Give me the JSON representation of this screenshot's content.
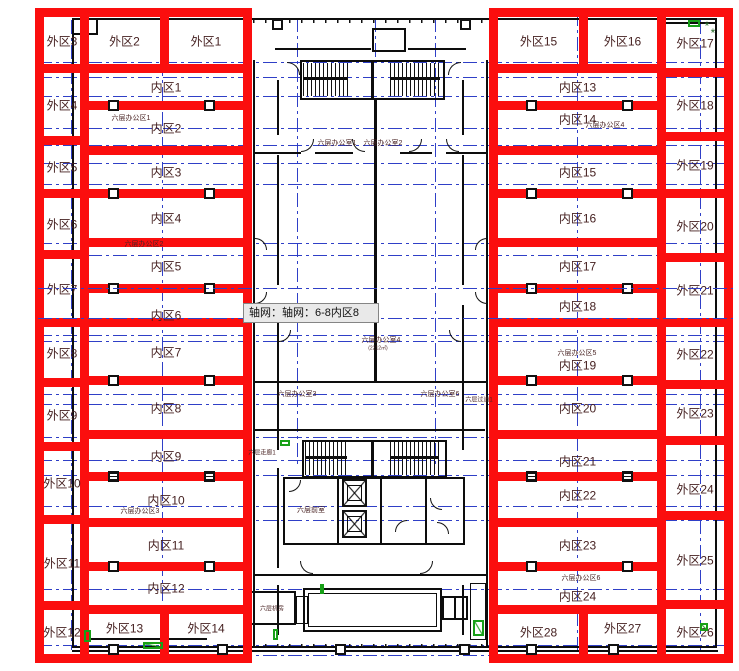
{
  "colors": {
    "red": "#fb0e0e",
    "axis_blue": "#2f3fc7",
    "plan_black": "#0d0d0d",
    "label_maroon": "#441f1f",
    "green": "#18a018",
    "tooltip_bg": "#e9e9e9",
    "tooltip_border": "#858585"
  },
  "tooltip": {
    "text": "轴网：轴网：6-8内区8",
    "x": 243,
    "y": 303,
    "w": 136,
    "h": 20
  },
  "zones": [
    {
      "label": "外区3",
      "x": 35,
      "y": 8,
      "w": 54,
      "h": 65
    },
    {
      "label": "外区4",
      "x": 35,
      "y": 64,
      "w": 54,
      "h": 81
    },
    {
      "label": "外区5",
      "x": 35,
      "y": 136,
      "w": 54,
      "h": 62
    },
    {
      "label": "外区6",
      "x": 35,
      "y": 189,
      "w": 54,
      "h": 70
    },
    {
      "label": "外区7",
      "x": 35,
      "y": 250,
      "w": 54,
      "h": 77
    },
    {
      "label": "外区8",
      "x": 35,
      "y": 318,
      "w": 54,
      "h": 69
    },
    {
      "label": "外区9",
      "x": 35,
      "y": 378,
      "w": 54,
      "h": 73
    },
    {
      "label": "外区10",
      "x": 35,
      "y": 442,
      "w": 54,
      "h": 82
    },
    {
      "label": "外区11",
      "x": 35,
      "y": 515,
      "w": 54,
      "h": 95
    },
    {
      "label": "外区12",
      "x": 35,
      "y": 601,
      "w": 54,
      "h": 62
    },
    {
      "label": "外区2",
      "x": 80,
      "y": 8,
      "w": 89,
      "h": 65
    },
    {
      "label": "外区1",
      "x": 160,
      "y": 8,
      "w": 92,
      "h": 65
    },
    {
      "label": "内区1",
      "x": 80,
      "y": 64,
      "w": 172,
      "h": 46
    },
    {
      "label": "内区2",
      "x": 80,
      "y": 101,
      "w": 172,
      "h": 54
    },
    {
      "label": "内区3",
      "x": 80,
      "y": 146,
      "w": 172,
      "h": 52
    },
    {
      "label": "内区4",
      "x": 80,
      "y": 189,
      "w": 172,
      "h": 58
    },
    {
      "label": "内区5",
      "x": 80,
      "y": 238,
      "w": 172,
      "h": 55
    },
    {
      "label": "内区6",
      "x": 80,
      "y": 284,
      "w": 172,
      "h": 43,
      "dy": 9
    },
    {
      "label": "内区7",
      "x": 80,
      "y": 318,
      "w": 172,
      "h": 67
    },
    {
      "label": "内区8",
      "x": 80,
      "y": 376,
      "w": 172,
      "h": 63
    },
    {
      "label": "内区9",
      "x": 80,
      "y": 430,
      "w": 172,
      "h": 51
    },
    {
      "label": "内区10",
      "x": 80,
      "y": 472,
      "w": 172,
      "h": 55
    },
    {
      "label": "内区11",
      "x": 80,
      "y": 518,
      "w": 172,
      "h": 53
    },
    {
      "label": "内区12",
      "x": 80,
      "y": 562,
      "w": 172,
      "h": 52
    },
    {
      "label": "外区13",
      "x": 80,
      "y": 605,
      "w": 89,
      "h": 58,
      "dy": -6
    },
    {
      "label": "外区14",
      "x": 160,
      "y": 605,
      "w": 92,
      "h": 58,
      "dy": -6
    },
    {
      "label": "外区15",
      "x": 489,
      "y": 8,
      "w": 99,
      "h": 65
    },
    {
      "label": "外区16",
      "x": 579,
      "y": 8,
      "w": 87,
      "h": 65
    },
    {
      "label": "内区13",
      "x": 489,
      "y": 64,
      "w": 177,
      "h": 46
    },
    {
      "label": "内区14",
      "x": 489,
      "y": 101,
      "w": 177,
      "h": 54,
      "dy": -9
    },
    {
      "label": "内区15",
      "x": 489,
      "y": 146,
      "w": 177,
      "h": 52
    },
    {
      "label": "内区16",
      "x": 489,
      "y": 189,
      "w": 177,
      "h": 58
    },
    {
      "label": "内区17",
      "x": 489,
      "y": 238,
      "w": 177,
      "h": 55
    },
    {
      "label": "内区18",
      "x": 489,
      "y": 284,
      "w": 177,
      "h": 43
    },
    {
      "label": "内区19",
      "x": 489,
      "y": 318,
      "w": 177,
      "h": 67,
      "dy": 13
    },
    {
      "label": "内区20",
      "x": 489,
      "y": 376,
      "w": 177,
      "h": 63
    },
    {
      "label": "内区21",
      "x": 489,
      "y": 430,
      "w": 177,
      "h": 51,
      "dy": 5
    },
    {
      "label": "内区22",
      "x": 489,
      "y": 472,
      "w": 177,
      "h": 55,
      "dy": -5
    },
    {
      "label": "内区23",
      "x": 489,
      "y": 518,
      "w": 177,
      "h": 53
    },
    {
      "label": "内区24",
      "x": 489,
      "y": 562,
      "w": 177,
      "h": 52,
      "dy": 8
    },
    {
      "label": "外区28",
      "x": 489,
      "y": 605,
      "w": 99,
      "h": 58,
      "dy": -2
    },
    {
      "label": "外区27",
      "x": 579,
      "y": 605,
      "w": 87,
      "h": 58,
      "dy": -6
    },
    {
      "label": "外区17",
      "x": 657,
      "y": 8,
      "w": 76,
      "h": 69
    },
    {
      "label": "外区18",
      "x": 657,
      "y": 68,
      "w": 76,
      "h": 73
    },
    {
      "label": "外区19",
      "x": 657,
      "y": 132,
      "w": 76,
      "h": 66
    },
    {
      "label": "外区20",
      "x": 657,
      "y": 189,
      "w": 76,
      "h": 73
    },
    {
      "label": "外区21",
      "x": 657,
      "y": 253,
      "w": 76,
      "h": 74
    },
    {
      "label": "外区22",
      "x": 657,
      "y": 318,
      "w": 76,
      "h": 71
    },
    {
      "label": "外区23",
      "x": 657,
      "y": 380,
      "w": 76,
      "h": 65
    },
    {
      "label": "外区24",
      "x": 657,
      "y": 436,
      "w": 76,
      "h": 84,
      "dy": 11
    },
    {
      "label": "外区25",
      "x": 657,
      "y": 511,
      "w": 76,
      "h": 98
    },
    {
      "label": "外区26",
      "x": 657,
      "y": 600,
      "w": 76,
      "h": 63
    }
  ],
  "texts": [
    {
      "t": "六层办公区1",
      "x": 131,
      "y": 118,
      "s": 7
    },
    {
      "t": "六层办公区2",
      "x": 144,
      "y": 244,
      "s": 7
    },
    {
      "t": "六层办公区3",
      "x": 140,
      "y": 511,
      "s": 7
    },
    {
      "t": "六层办公区4",
      "x": 605,
      "y": 125,
      "s": 7
    },
    {
      "t": "六层办公区5",
      "x": 577,
      "y": 353,
      "s": 7
    },
    {
      "t": "六层办公区6",
      "x": 581,
      "y": 578,
      "s": 7
    },
    {
      "t": "六层办公室1",
      "x": 337,
      "y": 143,
      "s": 7
    },
    {
      "t": "六层办公室2",
      "x": 383,
      "y": 143,
      "s": 7
    },
    {
      "t": "六层办公室4",
      "x": 381,
      "y": 340,
      "s": 7
    },
    {
      "t": "(2212㎡)",
      "x": 378,
      "y": 348,
      "s": 5
    },
    {
      "t": "六层办公室3",
      "x": 297,
      "y": 394,
      "s": 7
    },
    {
      "t": "六层办公室6",
      "x": 440,
      "y": 394,
      "s": 7
    },
    {
      "t": "六层过道1",
      "x": 479,
      "y": 399,
      "s": 6
    },
    {
      "t": "六层走廊1",
      "x": 262,
      "y": 452,
      "s": 6
    },
    {
      "t": "六层前室",
      "x": 311,
      "y": 510,
      "s": 7
    },
    {
      "t": "六层机房",
      "x": 272,
      "y": 608,
      "s": 6
    },
    {
      "t": "*",
      "x": 707,
      "y": 26,
      "s": 12,
      "c": "#2a6b2a"
    },
    {
      "t": "*",
      "x": 713,
      "y": 33,
      "s": 12,
      "c": "#2a6b2a"
    }
  ],
  "plan": {
    "outline": {
      "x": 72,
      "y": 18,
      "w": 645,
      "h": 630
    },
    "hlines": [
      {
        "y": 62
      },
      {
        "y": 77
      },
      {
        "y": 96
      },
      {
        "y": 128
      },
      {
        "y": 145
      },
      {
        "y": 163
      },
      {
        "y": 184
      },
      {
        "y": 243
      },
      {
        "y": 255
      },
      {
        "y": 288,
        "over": 1
      },
      {
        "y": 318,
        "over": 1
      },
      {
        "y": 335
      },
      {
        "y": 341
      },
      {
        "y": 394
      },
      {
        "y": 404
      },
      {
        "y": 437
      },
      {
        "y": 460
      },
      {
        "y": 475
      },
      {
        "y": 506
      },
      {
        "y": 520
      },
      {
        "y": 589
      },
      {
        "y": 645
      },
      {
        "y": 655
      }
    ],
    "hline_x": [
      38,
      733
    ],
    "vlines": [
      {
        "x": 71,
        "y1": 20,
        "y2": 650
      },
      {
        "x": 162,
        "y1": 12,
        "y2": 658
      },
      {
        "x": 297,
        "y1": 18,
        "y2": 465
      },
      {
        "x": 375,
        "y1": 18,
        "y2": 58
      },
      {
        "x": 435,
        "y1": 18,
        "y2": 465
      },
      {
        "x": 577,
        "y1": 12,
        "y2": 658
      },
      {
        "x": 700,
        "y1": 20,
        "y2": 650
      }
    ],
    "bars": [
      [
        72,
        650,
        646,
        2
      ],
      [
        72,
        33,
        26,
        2
      ],
      [
        96,
        19,
        2,
        16
      ],
      [
        657,
        22,
        60,
        2
      ],
      [
        80,
        638,
        127,
        2
      ],
      [
        80,
        570,
        2,
        70
      ],
      [
        371,
        60,
        3,
        40
      ],
      [
        303,
        77,
        45,
        3
      ],
      [
        390,
        77,
        50,
        3
      ],
      [
        275,
        48,
        96,
        2
      ],
      [
        408,
        48,
        58,
        2
      ],
      [
        253,
        60,
        2,
        588
      ],
      [
        486,
        60,
        2,
        588
      ],
      [
        277,
        80,
        2,
        55
      ],
      [
        277,
        155,
        2,
        130
      ],
      [
        277,
        305,
        2,
        145
      ],
      [
        277,
        468,
        2,
        100
      ],
      [
        277,
        585,
        2,
        50
      ],
      [
        462,
        80,
        2,
        55
      ],
      [
        462,
        155,
        2,
        130
      ],
      [
        462,
        305,
        2,
        145
      ],
      [
        462,
        585,
        2,
        50
      ],
      [
        255,
        152,
        46,
        2
      ],
      [
        315,
        152,
        38,
        2
      ],
      [
        400,
        152,
        32,
        2
      ],
      [
        446,
        152,
        40,
        2
      ],
      [
        255,
        429,
        230,
        2
      ],
      [
        253,
        381,
        234,
        2
      ],
      [
        374,
        100,
        3,
        282
      ],
      [
        283,
        477,
        182,
        2
      ],
      [
        283,
        543,
        182,
        2
      ],
      [
        283,
        477,
        2,
        68
      ],
      [
        337,
        477,
        2,
        68
      ],
      [
        380,
        477,
        2,
        68
      ],
      [
        425,
        477,
        2,
        68
      ],
      [
        463,
        477,
        2,
        68
      ],
      [
        371,
        440,
        3,
        38
      ],
      [
        305,
        456,
        42,
        3
      ],
      [
        390,
        456,
        49,
        3
      ],
      [
        454,
        596,
        2,
        24
      ],
      [
        379,
        50,
        16,
        2
      ],
      [
        253,
        574,
        234,
        2
      ]
    ],
    "ticks": [
      [
        253,
        19,
        234,
        4
      ],
      [
        253,
        644,
        234,
        4
      ]
    ],
    "boxes": [
      [
        372,
        28,
        34,
        24,
        2
      ],
      [
        300,
        60,
        145,
        40,
        2
      ],
      [
        302,
        440,
        145,
        38,
        2
      ],
      [
        303,
        588,
        139,
        44,
        2
      ],
      [
        308,
        593,
        129,
        34,
        1
      ],
      [
        250,
        591,
        46,
        34,
        2
      ],
      [
        296,
        596,
        12,
        28,
        1
      ],
      [
        442,
        596,
        26,
        24,
        2
      ],
      [
        470,
        583,
        16,
        57,
        1
      ],
      [
        347,
        485,
        15,
        16,
        1
      ],
      [
        347,
        516,
        15,
        16,
        1
      ]
    ],
    "stairs": [
      [
        303,
        63,
        45,
        33
      ],
      [
        390,
        63,
        50,
        33
      ],
      [
        305,
        442,
        42,
        33
      ],
      [
        390,
        442,
        49,
        33
      ]
    ],
    "elevators": [
      [
        342,
        479,
        25,
        28
      ],
      [
        342,
        510,
        25,
        28
      ]
    ],
    "columns": [
      {
        "x": 113,
        "y": 105
      },
      {
        "x": 209,
        "y": 105
      },
      {
        "x": 531,
        "y": 105
      },
      {
        "x": 627,
        "y": 105
      },
      {
        "x": 113,
        "y": 193
      },
      {
        "x": 209,
        "y": 193
      },
      {
        "x": 531,
        "y": 193
      },
      {
        "x": 627,
        "y": 193
      },
      {
        "x": 113,
        "y": 288
      },
      {
        "x": 209,
        "y": 288
      },
      {
        "x": 531,
        "y": 288
      },
      {
        "x": 627,
        "y": 288
      },
      {
        "x": 113,
        "y": 380
      },
      {
        "x": 209,
        "y": 380
      },
      {
        "x": 531,
        "y": 380
      },
      {
        "x": 627,
        "y": 380
      },
      {
        "x": 113,
        "y": 476,
        "s": 1
      },
      {
        "x": 209,
        "y": 476,
        "s": 1
      },
      {
        "x": 531,
        "y": 476,
        "s": 1
      },
      {
        "x": 627,
        "y": 476,
        "s": 1
      },
      {
        "x": 113,
        "y": 566
      },
      {
        "x": 209,
        "y": 566
      },
      {
        "x": 531,
        "y": 566
      },
      {
        "x": 627,
        "y": 566
      },
      {
        "x": 113,
        "y": 649
      },
      {
        "x": 222,
        "y": 649
      },
      {
        "x": 340,
        "y": 649
      },
      {
        "x": 464,
        "y": 649
      },
      {
        "x": 531,
        "y": 649
      },
      {
        "x": 613,
        "y": 649
      },
      {
        "x": 277,
        "y": 24
      },
      {
        "x": 465,
        "y": 24
      }
    ],
    "doors": [
      [
        287,
        62,
        13,
        "tr"
      ],
      [
        448,
        62,
        13,
        "tl"
      ],
      [
        301,
        139,
        13,
        "br"
      ],
      [
        352,
        139,
        13,
        "bl"
      ],
      [
        409,
        139,
        13,
        "br"
      ],
      [
        446,
        139,
        13,
        "bl"
      ],
      [
        255,
        238,
        12,
        "tr"
      ],
      [
        255,
        292,
        12,
        "br"
      ],
      [
        475,
        238,
        12,
        "tl"
      ],
      [
        475,
        292,
        12,
        "bl"
      ],
      [
        279,
        330,
        12,
        "br"
      ],
      [
        449,
        330,
        12,
        "bl"
      ],
      [
        289,
        480,
        12,
        "br"
      ],
      [
        395,
        520,
        12,
        "tl"
      ],
      [
        430,
        498,
        12,
        "bl"
      ],
      [
        437,
        522,
        12,
        "tr"
      ],
      [
        300,
        561,
        13,
        "bl"
      ],
      [
        420,
        561,
        13,
        "br"
      ]
    ],
    "greens": [
      [
        688,
        20,
        12,
        7,
        0
      ],
      [
        280,
        440,
        10,
        6,
        0
      ],
      [
        84,
        630,
        7,
        12,
        0
      ],
      [
        143,
        642,
        20,
        7,
        1
      ],
      [
        273,
        629,
        5,
        11,
        0
      ],
      [
        473,
        620,
        11,
        16,
        1
      ],
      [
        700,
        623,
        8,
        8,
        1
      ],
      [
        320,
        584,
        4,
        10,
        0
      ]
    ]
  }
}
